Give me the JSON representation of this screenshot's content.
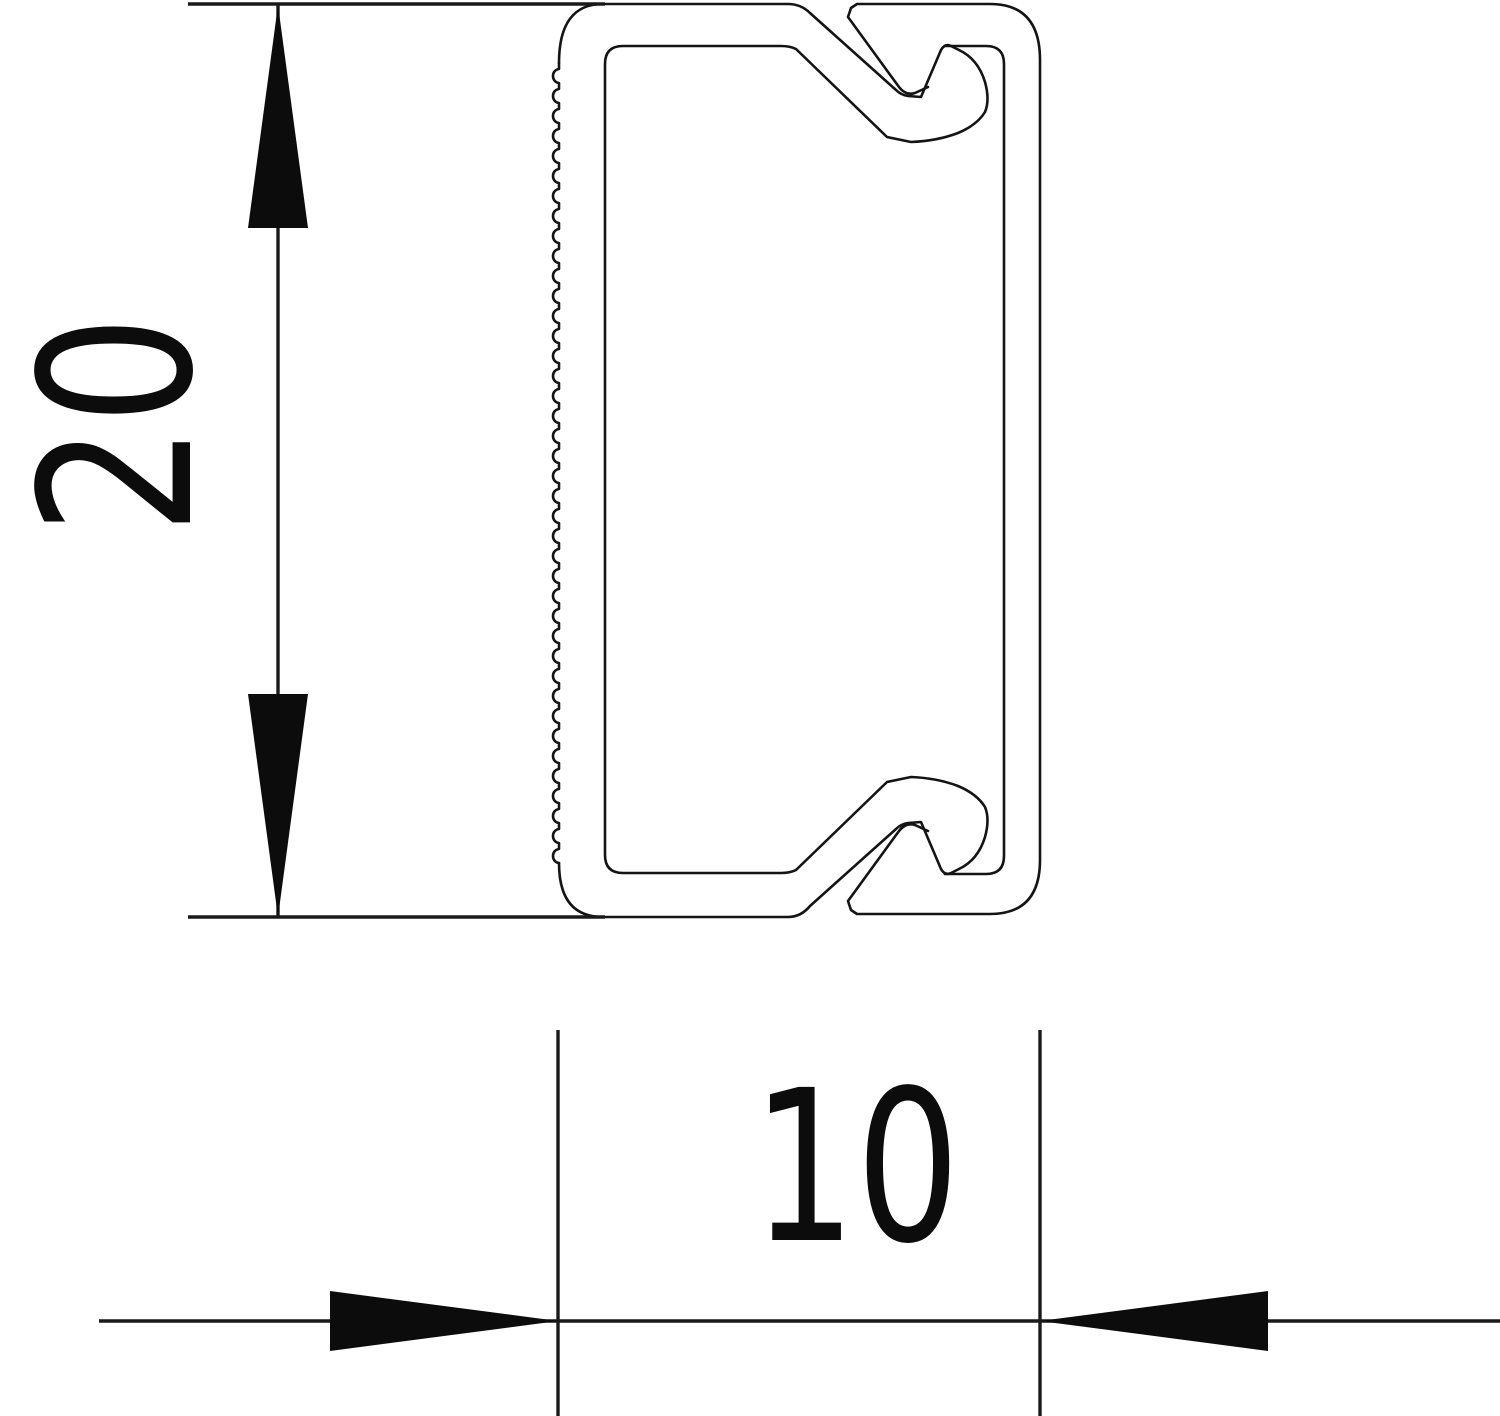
{
  "drawing": {
    "kind": "trunking-cross-section",
    "colors": {
      "line": "#141414",
      "arrow": "#0c0c0c",
      "background": "#ffffff"
    },
    "dimensions": {
      "height": {
        "value": "20",
        "orientation": "vertical-rotated"
      },
      "width": {
        "value": "10",
        "orientation": "horizontal"
      }
    },
    "icons": {
      "height_top_arrow": "arrow-up-icon",
      "height_bottom_arrow": "arrow-down-icon",
      "width_left_arrow": "arrow-right-icon",
      "width_right_arrow": "arrow-left-icon"
    }
  }
}
